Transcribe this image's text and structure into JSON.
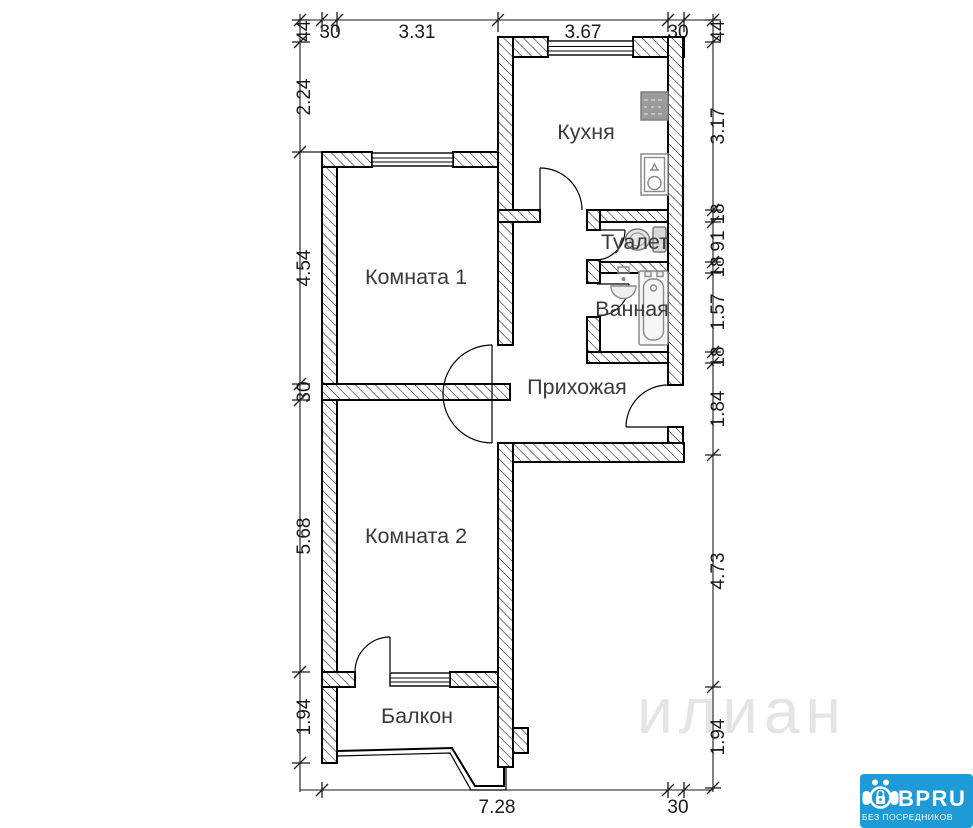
{
  "rooms": {
    "kitchen": "Кухня",
    "toilet": "Туалет",
    "bathroom": "Ванная",
    "hallway": "Прихожая",
    "room1": "Комната 1",
    "room2": "Комната 2",
    "balcony": "Балкон"
  },
  "dimensions": {
    "top": [
      "30",
      "3.31",
      "3.67",
      "30"
    ],
    "left": [
      "44",
      "2.24",
      "4.54",
      "30",
      "5.68",
      "1.94"
    ],
    "right": [
      "44",
      "3.17",
      "18",
      "91",
      "18",
      "1.57",
      "18",
      "1.84",
      "4.73",
      "1.94"
    ],
    "bottom": [
      "7.28",
      "30"
    ]
  },
  "watermark": "илиан",
  "logo": {
    "brand": "BPRU",
    "tagline": "БЕЗ ПОСРЕДНИКОВ",
    "background": "#1e9bd7",
    "text_color": "#ffffff"
  },
  "icons": {
    "kitchen": [
      "stove-icon",
      "kitchen-sink-icon"
    ],
    "toilet": [
      "toilet-icon"
    ],
    "bathroom": [
      "washbasin-icon",
      "bathtub-icon"
    ]
  },
  "colors": {
    "wall_line": "#000000",
    "label": "#3a3a3a",
    "dimension": "#1a1a1a",
    "watermark": "#e5e5e5"
  }
}
